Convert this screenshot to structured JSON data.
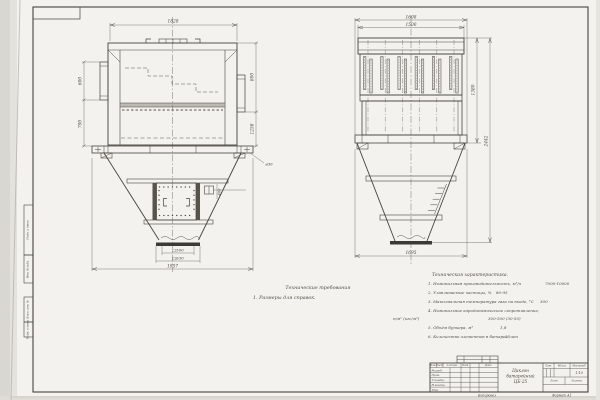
{
  "left_view": {
    "dims": {
      "top_width": "1828",
      "left_upper": "600",
      "left_lower": "700",
      "right_upper": "800",
      "right_lower": "1258",
      "hole": "ø30",
      "hatch": "400",
      "outlet_inner": "□500",
      "outlet_outer": "□630",
      "bottom_width": "1957"
    }
  },
  "right_view": {
    "dims": {
      "top_outer": "1608",
      "top_inner": "1500",
      "right_inner": "1380",
      "right_outer": "2442",
      "bottom_width": "1695"
    }
  },
  "notes": {
    "title": "Технические требования",
    "items": [
      "1. Размеры для справок."
    ]
  },
  "specs": {
    "title": "Техническая характеристика.",
    "rows": [
      {
        "label": "1. Номинальная производительность, м³/ч",
        "value": "7000-10000"
      },
      {
        "label": "2. Улавливаемые частицы, %",
        "value": "80-95"
      },
      {
        "label": "3. Максимальная температура газа на входе, °С",
        "value": "300"
      },
      {
        "label": "4. Номинальное аэродинамическое сопротивление,",
        "value": ""
      },
      {
        "label": "н/м² (кгс/м²)",
        "value": "300-500 (30-50)"
      },
      {
        "label": "5. Объём бункера, м³",
        "value": "1,8"
      },
      {
        "label": "6. Количество элементов в батарее, шт",
        "value": "25"
      }
    ]
  },
  "title_block": {
    "doc_title_line1": "Циклон",
    "doc_title_line2": "батарейный",
    "doc_title_line3": "ЦБ-25",
    "header_cells": [
      "Изм.",
      "Лист",
      "№ докум.",
      "Подп.",
      "Дата"
    ],
    "rows": [
      "Разраб.",
      "Пров.",
      "Т.контр.",
      "Н.контр.",
      "Утв."
    ],
    "lit_label": "Лит.",
    "mass_label": "Масса",
    "scale_label": "Масштаб",
    "scale_value": "1:10",
    "sheet_label": "Лист",
    "sheets_label": "Листов",
    "copied_label": "Копировал",
    "format_label": "Формат А1"
  },
  "margin_labels": [
    "Подп. и дата",
    "Инв. № дубл.",
    "Взам. инв. №",
    "Подп. и дата"
  ]
}
